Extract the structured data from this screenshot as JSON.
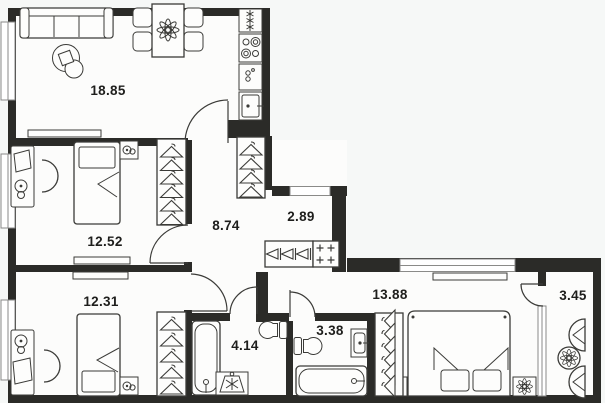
{
  "plan": {
    "title": "apartment-floor-plan",
    "rooms": [
      {
        "name": "living-room-kitchen",
        "area": "18.85"
      },
      {
        "name": "bedroom-top",
        "area": "12.52"
      },
      {
        "name": "hallway",
        "area": "8.74"
      },
      {
        "name": "entry-hall",
        "area": "2.89"
      },
      {
        "name": "bedroom-left",
        "area": "12.31"
      },
      {
        "name": "bathroom-large",
        "area": "4.14"
      },
      {
        "name": "bathroom-small",
        "area": "3.38"
      },
      {
        "name": "bedroom-master",
        "area": "13.88"
      },
      {
        "name": "balcony",
        "area": "3.45"
      }
    ],
    "colors": {
      "wall": "#2b2b28",
      "background": "#f6f8f7",
      "floor": "#fcfcfb",
      "furniture_line": "#3b3b38"
    }
  }
}
